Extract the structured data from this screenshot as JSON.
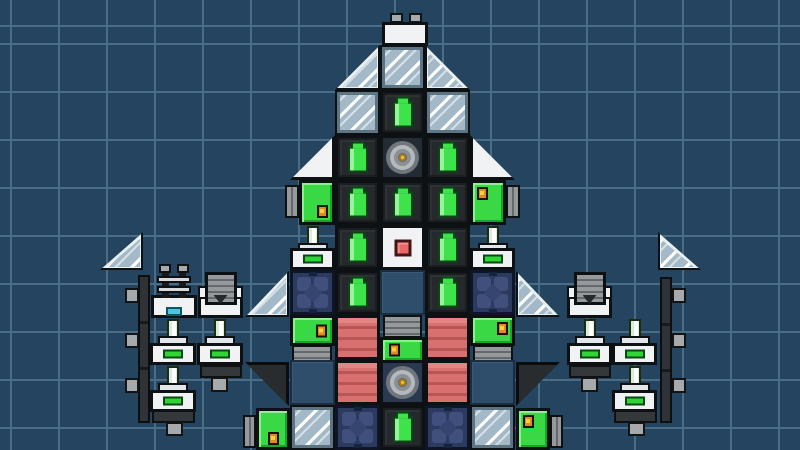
{
  "scene": {
    "width": 800,
    "height": 450
  },
  "grid": {
    "cell": 48,
    "offset_x": 10,
    "offset_y": 43,
    "line_width": 2
  },
  "palette": {
    "bg": "#24445f",
    "gridLine": "#4a6d86",
    "outline": "#0e1113",
    "white": "#f0f2f3",
    "blockDark": "#25292c",
    "battGreen": "#3ee24a",
    "battGreenDark": "#0b4716",
    "battGreenLight": "#9af29a",
    "glassBase": "#a3b9c7",
    "glassFrame": "#5d7482",
    "glassLight": "#e8f1f5",
    "slate": "#2f4e6c",
    "slateDark": "#1b2e41",
    "redBase": "#d97070",
    "redDark": "#b85656",
    "redLight": "#e38585",
    "navyBase": "#2b3a5e",
    "navyPetal": "#404f7c",
    "navyDiamond": "#364570",
    "navyDark": "#16233c",
    "navyOutline": "#0d1526",
    "green": "#38d944",
    "greenLight": "#8eef8e",
    "greenDark": "#17a626",
    "grayVent": "#95999c",
    "grayVentDark": "#64686b",
    "darkTri": "#282c2f",
    "gyroBgA": "#232b35",
    "gyroBgB": "#2b3950",
    "gyroR1": "#70767b",
    "gyroR2": "#b4b9bd",
    "gyroR3": "#8a9094",
    "gyroR4": "#5e6367",
    "gyroYellow": "#f4c62f",
    "gyroYellowDark": "#b07d18",
    "coreRed": "#eb6868",
    "coreRedDark": "#451515",
    "dotOrange": "#e08a22",
    "dotYellow": "#f8d040",
    "dotDark": "#1d1207",
    "rodFill": "#d8eed6",
    "rodDark": "#1d2b15",
    "capGray": "#ccd0d2",
    "indGreen": "#2fd435",
    "stripDark": "#2f3337",
    "nubGray": "#a6aaad",
    "connDark": "#34383b",
    "cyanSlot": "#4fc4de",
    "cyanDark": "#0e5666",
    "postDark": "#17191b",
    "barLight": "#d6dadd"
  },
  "blocks": [
    {
      "t": "strip",
      "x": 138,
      "y": 275,
      "w": 12,
      "h": 148
    },
    {
      "t": "strip",
      "x": 660,
      "y": 277,
      "w": 12,
      "h": 146
    },
    {
      "t": "nub",
      "x": 125,
      "y": 288,
      "w": 14,
      "h": 15
    },
    {
      "t": "nub",
      "x": 125,
      "y": 333,
      "w": 14,
      "h": 15
    },
    {
      "t": "nub",
      "x": 125,
      "y": 378,
      "w": 14,
      "h": 15
    },
    {
      "t": "nub",
      "x": 672,
      "y": 288,
      "w": 14,
      "h": 15
    },
    {
      "t": "nub",
      "x": 672,
      "y": 333,
      "w": 14,
      "h": 15
    },
    {
      "t": "nub",
      "x": 672,
      "y": 378,
      "w": 14,
      "h": 15
    },
    {
      "t": "conn",
      "x": 200,
      "y": 365,
      "w": 42,
      "h": 13
    },
    {
      "t": "nub",
      "x": 211,
      "y": 377,
      "w": 17,
      "h": 15
    },
    {
      "t": "conn",
      "x": 152,
      "y": 410,
      "w": 43,
      "h": 13
    },
    {
      "t": "nub",
      "x": 166,
      "y": 422,
      "w": 17,
      "h": 14
    },
    {
      "t": "conn",
      "x": 569,
      "y": 365,
      "w": 42,
      "h": 13
    },
    {
      "t": "nub",
      "x": 581,
      "y": 377,
      "w": 17,
      "h": 15
    },
    {
      "t": "conn",
      "x": 614,
      "y": 410,
      "w": 43,
      "h": 13
    },
    {
      "t": "nub",
      "x": 628,
      "y": 422,
      "w": 17,
      "h": 14
    },
    {
      "t": "glasstri",
      "dir": "br",
      "x": 100,
      "y": 232,
      "w": 43,
      "h": 38
    },
    {
      "t": "glasstri",
      "dir": "bl",
      "x": 658,
      "y": 232,
      "w": 43,
      "h": 38
    },
    {
      "t": "rail",
      "x": 151,
      "y": 264,
      "w": 46,
      "h": 54
    },
    {
      "t": "nozzle",
      "x": 198,
      "y": 272,
      "w": 45,
      "h": 46
    },
    {
      "t": "nozzle",
      "x": 567,
      "y": 272,
      "w": 45,
      "h": 46
    },
    {
      "t": "piston",
      "x": 150,
      "y": 318,
      "w": 46,
      "h": 47
    },
    {
      "t": "piston",
      "x": 197,
      "y": 318,
      "w": 46,
      "h": 47
    },
    {
      "t": "piston",
      "x": 567,
      "y": 318,
      "w": 45,
      "h": 47
    },
    {
      "t": "piston",
      "x": 612,
      "y": 318,
      "w": 45,
      "h": 47
    },
    {
      "t": "piston",
      "x": 150,
      "y": 365,
      "w": 46,
      "h": 47
    },
    {
      "t": "piston",
      "x": 612,
      "y": 365,
      "w": 45,
      "h": 47
    },
    {
      "t": "nub",
      "x": 390,
      "y": 13,
      "w": 13,
      "h": 10
    },
    {
      "t": "nub",
      "x": 409,
      "y": 13,
      "w": 13,
      "h": 10
    },
    {
      "t": "white",
      "x": 382,
      "y": 22,
      "w": 46,
      "h": 24
    },
    {
      "t": "glasstri",
      "dir": "br",
      "x": 335,
      "y": 45,
      "w": 45,
      "h": 45
    },
    {
      "t": "glass",
      "x": 380,
      "y": 45,
      "w": 45,
      "h": 45
    },
    {
      "t": "glasstri",
      "dir": "bl",
      "x": 425,
      "y": 45,
      "w": 45,
      "h": 45
    },
    {
      "t": "glass",
      "x": 335,
      "y": 90,
      "w": 45,
      "h": 45
    },
    {
      "t": "battery",
      "x": 380,
      "y": 90,
      "w": 45,
      "h": 45
    },
    {
      "t": "glass",
      "x": 425,
      "y": 90,
      "w": 45,
      "h": 45
    },
    {
      "t": "whitetri",
      "dir": "br",
      "x": 290,
      "y": 135,
      "w": 45,
      "h": 45
    },
    {
      "t": "battery",
      "x": 335,
      "y": 135,
      "w": 45,
      "h": 45
    },
    {
      "t": "gyro",
      "x": 380,
      "y": 135,
      "w": 45,
      "h": 45
    },
    {
      "t": "battery",
      "x": 425,
      "y": 135,
      "w": 45,
      "h": 45
    },
    {
      "t": "whitetri",
      "dir": "bl",
      "x": 470,
      "y": 135,
      "w": 45,
      "h": 45
    },
    {
      "t": "radiator",
      "o": "v",
      "x": 285,
      "y": 185,
      "w": 14,
      "h": 33
    },
    {
      "t": "green",
      "x": 299,
      "y": 180,
      "w": 36,
      "h": 45,
      "dot": "br"
    },
    {
      "t": "battery",
      "x": 335,
      "y": 180,
      "w": 45,
      "h": 45
    },
    {
      "t": "battery",
      "x": 380,
      "y": 180,
      "w": 45,
      "h": 45
    },
    {
      "t": "battery",
      "x": 425,
      "y": 180,
      "w": 45,
      "h": 45
    },
    {
      "t": "green",
      "x": 470,
      "y": 180,
      "w": 36,
      "h": 45,
      "dot": "tl"
    },
    {
      "t": "radiator",
      "o": "v",
      "x": 506,
      "y": 185,
      "w": 14,
      "h": 33
    },
    {
      "t": "piston",
      "x": 290,
      "y": 225,
      "w": 45,
      "h": 45
    },
    {
      "t": "battery",
      "x": 335,
      "y": 225,
      "w": 45,
      "h": 45
    },
    {
      "t": "core",
      "x": 380,
      "y": 225,
      "w": 45,
      "h": 45
    },
    {
      "t": "battery",
      "x": 425,
      "y": 225,
      "w": 45,
      "h": 45
    },
    {
      "t": "piston",
      "x": 470,
      "y": 225,
      "w": 45,
      "h": 45
    },
    {
      "t": "glasstri",
      "dir": "br",
      "x": 245,
      "y": 271,
      "w": 44,
      "h": 46
    },
    {
      "t": "navyx",
      "x": 290,
      "y": 270,
      "w": 45,
      "h": 45
    },
    {
      "t": "battery",
      "x": 335,
      "y": 270,
      "w": 45,
      "h": 45
    },
    {
      "t": "slate",
      "x": 380,
      "y": 270,
      "w": 45,
      "h": 45
    },
    {
      "t": "battery",
      "x": 425,
      "y": 270,
      "w": 45,
      "h": 45
    },
    {
      "t": "navyx",
      "x": 470,
      "y": 270,
      "w": 45,
      "h": 45
    },
    {
      "t": "glasstri",
      "dir": "bl",
      "x": 516,
      "y": 271,
      "w": 44,
      "h": 46
    },
    {
      "t": "radiator",
      "o": "h",
      "x": 292,
      "y": 345,
      "w": 40,
      "h": 18
    },
    {
      "t": "green",
      "x": 290,
      "y": 315,
      "w": 45,
      "h": 31,
      "dot": "r"
    },
    {
      "t": "red",
      "x": 335,
      "y": 315,
      "w": 45,
      "h": 45
    },
    {
      "t": "radiator",
      "o": "h",
      "x": 383,
      "y": 315,
      "w": 39,
      "h": 23
    },
    {
      "t": "green",
      "x": 380,
      "y": 337,
      "w": 45,
      "h": 26,
      "dot": "l"
    },
    {
      "t": "red",
      "x": 425,
      "y": 315,
      "w": 45,
      "h": 45
    },
    {
      "t": "radiator",
      "o": "h",
      "x": 473,
      "y": 345,
      "w": 40,
      "h": 18
    },
    {
      "t": "green",
      "x": 470,
      "y": 315,
      "w": 45,
      "h": 31,
      "dot": "tr"
    },
    {
      "t": "darktri",
      "dir": "tr",
      "x": 245,
      "y": 362,
      "w": 44,
      "h": 44
    },
    {
      "t": "slate",
      "x": 290,
      "y": 360,
      "w": 45,
      "h": 45
    },
    {
      "t": "red",
      "x": 335,
      "y": 360,
      "w": 45,
      "h": 45
    },
    {
      "t": "gyro",
      "v": 2,
      "x": 380,
      "y": 360,
      "w": 45,
      "h": 45
    },
    {
      "t": "red",
      "x": 425,
      "y": 360,
      "w": 45,
      "h": 45
    },
    {
      "t": "slate",
      "x": 470,
      "y": 360,
      "w": 45,
      "h": 45
    },
    {
      "t": "darktri",
      "dir": "tl",
      "x": 516,
      "y": 362,
      "w": 44,
      "h": 44
    },
    {
      "t": "radiator",
      "o": "v",
      "x": 243,
      "y": 415,
      "w": 13,
      "h": 33
    },
    {
      "t": "green",
      "x": 256,
      "y": 408,
      "w": 34,
      "h": 42,
      "dot": "b"
    },
    {
      "t": "glass",
      "x": 290,
      "y": 405,
      "w": 45,
      "h": 45
    },
    {
      "t": "navyx",
      "x": 335,
      "y": 405,
      "w": 45,
      "h": 45
    },
    {
      "t": "battery",
      "x": 380,
      "y": 405,
      "w": 45,
      "h": 45
    },
    {
      "t": "navyx",
      "x": 425,
      "y": 405,
      "w": 45,
      "h": 45
    },
    {
      "t": "glass",
      "x": 470,
      "y": 405,
      "w": 45,
      "h": 45
    },
    {
      "t": "green",
      "x": 516,
      "y": 408,
      "w": 34,
      "h": 42,
      "dot": "tl"
    },
    {
      "t": "radiator",
      "o": "v",
      "x": 550,
      "y": 415,
      "w": 13,
      "h": 33
    }
  ]
}
